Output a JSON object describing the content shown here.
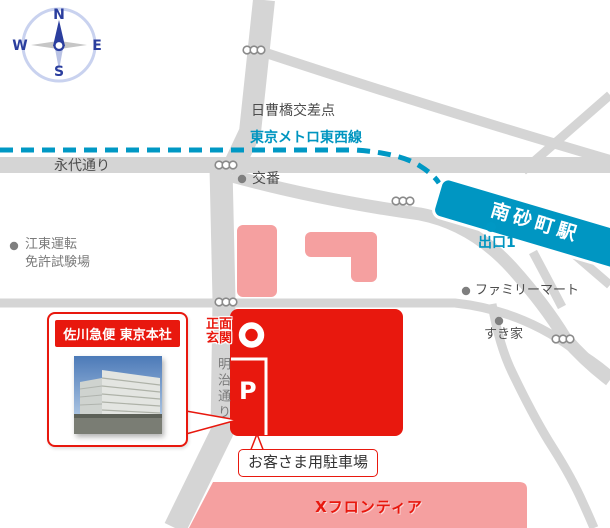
{
  "compass": {
    "north": "N",
    "south": "S",
    "east": "E",
    "west": "W"
  },
  "map": {
    "intersection_label": "日曹橋交差点",
    "metro_line_label": "東京メトロ東西線",
    "eitai_dori_label": "永代通り",
    "koban_label": "交番",
    "station_label": "南砂町駅",
    "exit_label": "出口1",
    "license_center_line1": "江東運転",
    "license_center_line2": "免許試験場",
    "familymart_label": "ファミリーマート",
    "sukiya_label": "すき家",
    "main_entrance_line1": "正面",
    "main_entrance_line2": "玄関",
    "meiji_dori_label": "明治通り",
    "parking_mark": "P",
    "customer_parking_label": "お客さま用駐車場",
    "x_frontier_label": "Xフロンティア",
    "hq_callout_title": "佐川急便 東京本社"
  },
  "colors": {
    "accent_red": "#e8180e",
    "metro_cyan": "#0098c4",
    "road_gray": "#d5d5d5",
    "building_pink": "#f5a0a0"
  }
}
